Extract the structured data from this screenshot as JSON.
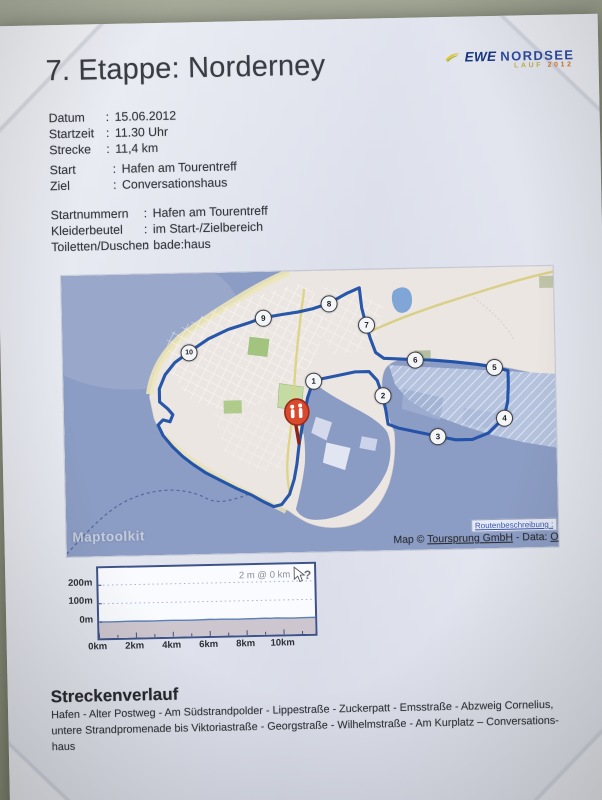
{
  "doc": {
    "title": "7. Etappe: Norderney",
    "colon": ":",
    "logo": {
      "brand": "EWE",
      "event": "NORDSEE",
      "sub1": "LAUF",
      "sub2": "2012"
    },
    "details": [
      {
        "label": "Datum",
        "value": "15.06.2012"
      },
      {
        "label": "Startzeit",
        "value": "11.30 Uhr"
      },
      {
        "label": "Strecke",
        "value": "11,4 km"
      }
    ],
    "startziel": [
      {
        "label": "Start",
        "value": "Hafen am Tourentreff"
      },
      {
        "label": "Ziel",
        "value": "Conversationshaus"
      }
    ],
    "logistics": [
      {
        "label": "Startnummern",
        "value": "Hafen am Tourentreff"
      },
      {
        "label": "Kleiderbeutel",
        "value": "im Start-/Zielbereich"
      },
      {
        "label": "Toiletten/Duschen",
        "value": "bade:haus"
      }
    ],
    "map": {
      "watermark": "Maptoolkit",
      "route_description_link": "Routenbeschreibung :",
      "credit": {
        "prefix": "Map © ",
        "link1": "Toursprung GmbH",
        "middle": " - Data: ",
        "link2": "O"
      },
      "markers": [
        {
          "n": "1",
          "x": 250,
          "y": 110
        },
        {
          "n": "2",
          "x": 319,
          "y": 126
        },
        {
          "n": "3",
          "x": 373,
          "y": 168
        },
        {
          "n": "4",
          "x": 440,
          "y": 151
        },
        {
          "n": "5",
          "x": 431,
          "y": 100
        },
        {
          "n": "6",
          "x": 352,
          "y": 91
        },
        {
          "n": "7",
          "x": 304,
          "y": 55
        },
        {
          "n": "8",
          "x": 267,
          "y": 33
        },
        {
          "n": "9",
          "x": 201,
          "y": 46
        },
        {
          "n": "10",
          "x": 126,
          "y": 79
        }
      ]
    },
    "course": {
      "heading": "Streckenverlauf",
      "lines": [
        "Hafen - Alter Postweg - Am Südstrandpolder - Lippestraße - Zuckerpatt - Emsstraße - Abzweig Cornelius,",
        "untere Strandpromenade bis Viktoriastraße - Georgstraße - Wilhelmstraße - Am Kurplatz – Conversations-",
        "haus"
      ]
    },
    "colors": {
      "route": "#1d4fa6",
      "sea": "#8c9dc5",
      "accent_blue": "#2c4ba0",
      "pin_red": "#d8492e"
    }
  },
  "chart_data": {
    "type": "area",
    "title": "",
    "tooltip": "2 m @ 0 km",
    "xlabel_ticks": [
      "0km",
      "2km",
      "4km",
      "6km",
      "8km",
      "10km"
    ],
    "ylabel_ticks": [
      "200m",
      "100m",
      "0m"
    ],
    "x_km": [
      0,
      0.5,
      1,
      1.5,
      2,
      2.5,
      3,
      3.5,
      4,
      4.5,
      5,
      5.5,
      6,
      6.3,
      6.6,
      7,
      7.5,
      8,
      8.5,
      9,
      9.3,
      9.6,
      10,
      10.5,
      11,
      11.4
    ],
    "elevation_m": [
      2,
      1,
      1,
      2,
      2,
      1,
      1,
      2,
      2,
      1,
      1,
      2,
      3,
      2,
      3,
      2,
      1,
      2,
      2,
      3,
      2,
      3,
      2,
      1,
      2,
      2
    ],
    "xlim_km": [
      0,
      11.7
    ],
    "ylim_m": [
      -85,
      290
    ],
    "grid": "dotted horizontal lines at 0m / 100m / 200m"
  }
}
